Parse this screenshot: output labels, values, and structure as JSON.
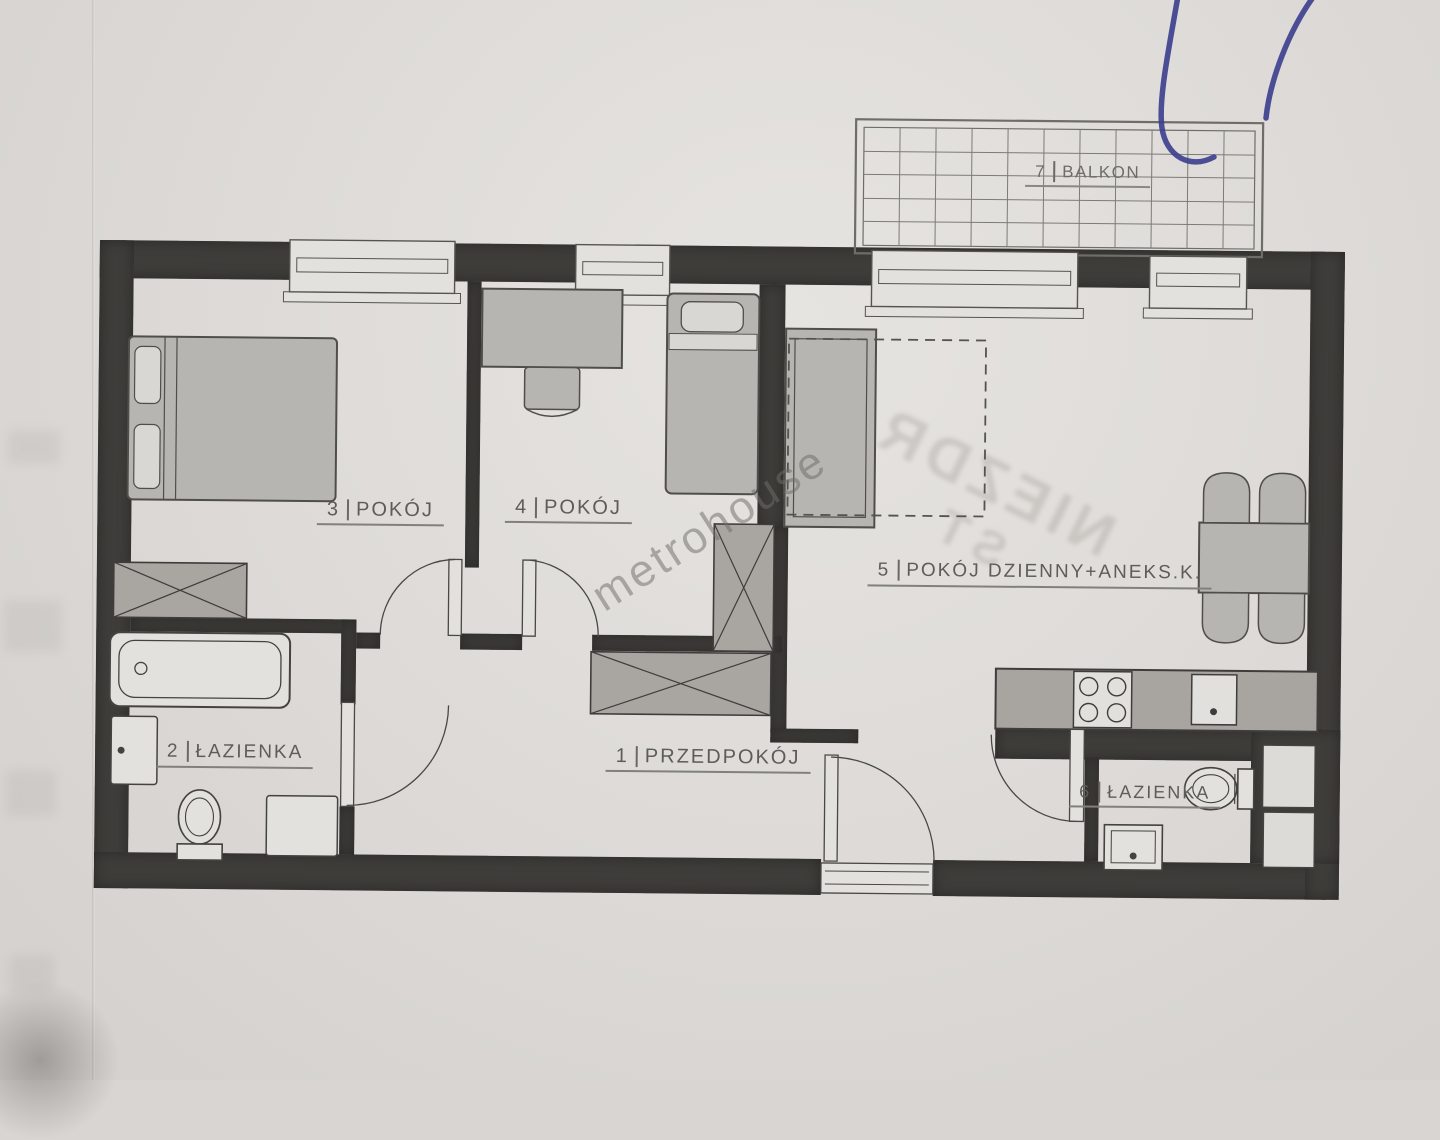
{
  "rooms": {
    "hallway": {
      "number": "1",
      "name": "PRZEDPOKÓJ"
    },
    "bathroom2": {
      "number": "2",
      "name": "ŁAZIENKA"
    },
    "room3": {
      "number": "3",
      "name": "POKÓJ"
    },
    "room4": {
      "number": "4",
      "name": "POKÓJ"
    },
    "living": {
      "number": "5",
      "name": "POKÓJ DZIENNY+ANEKS.K."
    },
    "bathroom6": {
      "number": "6",
      "name": "ŁAZIENKA"
    },
    "balcony": {
      "number": "7",
      "name": "BALKON"
    }
  },
  "watermarks": {
    "agency": "metrohouse",
    "stamp_line1": "NIEZDR",
    "stamp_line2": "ST"
  },
  "colors": {
    "wall": "#3f3d3a",
    "paper": "#dcd9d6",
    "furniture": "#b7b5b2",
    "hatch": "#a9a6a2",
    "ink": "#45433f",
    "pen": "#3b3e8e",
    "label_text": "#5e5c58"
  }
}
